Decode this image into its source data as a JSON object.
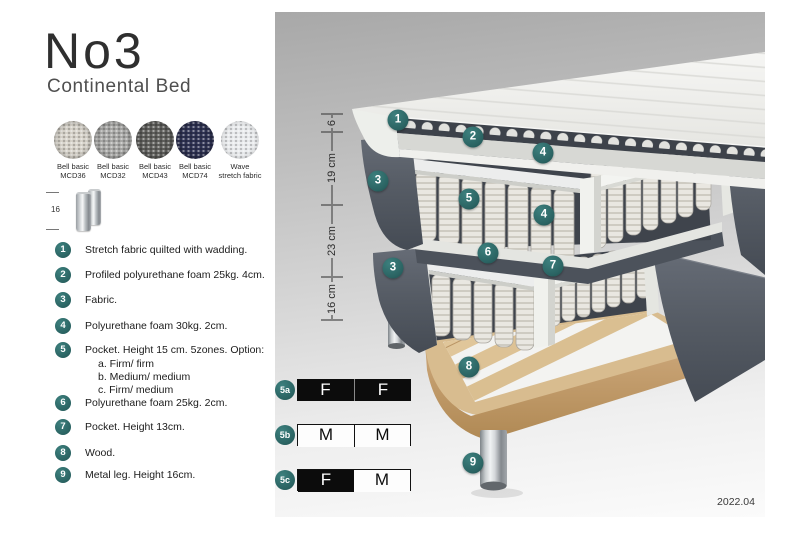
{
  "header": {
    "title": "No3",
    "subtitle": "Continental Bed"
  },
  "swatches": {
    "items": [
      {
        "line1": "Bell basic",
        "line2": "MCD36",
        "color": "#d6d2c9"
      },
      {
        "line1": "Bell basic",
        "line2": "MCD32",
        "color": "#a8a8a6"
      },
      {
        "line1": "Bell basic",
        "line2": "MCD43",
        "color": "#5e5e5b"
      },
      {
        "line1": "Bell basic",
        "line2": "MCD74",
        "color": "#2e3252"
      },
      {
        "line1": "Wave",
        "line2": "stretch fabric",
        "color": "#e9ebed"
      }
    ]
  },
  "leg_detail": {
    "dimension": "16"
  },
  "legend": {
    "badge_color": "#2e6e6d",
    "items": [
      {
        "num": "1",
        "text": "Stretch fabric quilted with wadding."
      },
      {
        "num": "2",
        "text": "Profiled polyurethane foam 25kg. 4cm."
      },
      {
        "num": "3",
        "text": "Fabric."
      },
      {
        "num": "4",
        "text": "Polyurethane foam 30kg. 2cm."
      },
      {
        "num": "5",
        "text": "Pocket. Height 15 cm. 5zones. Option:",
        "options": [
          "a. Firm/ firm",
          "b. Medium/ medium",
          "c. Firm/ medium"
        ]
      },
      {
        "num": "6",
        "text": "Polyurethane foam 25kg. 2cm."
      },
      {
        "num": "7",
        "text": "Pocket. Height 13cm."
      },
      {
        "num": "8",
        "text": "Wood."
      },
      {
        "num": "9",
        "text": "Metal leg. Height 16cm."
      }
    ]
  },
  "diagram": {
    "dimension_labels": [
      "6",
      "19 cm",
      "23 cm",
      "16 cm"
    ],
    "callouts": [
      {
        "num": "1"
      },
      {
        "num": "2"
      },
      {
        "num": "4"
      },
      {
        "num": "3"
      },
      {
        "num": "5"
      },
      {
        "num": "4"
      },
      {
        "num": "6"
      },
      {
        "num": "7"
      },
      {
        "num": "3"
      },
      {
        "num": "8"
      },
      {
        "num": "9"
      }
    ],
    "firmness_options": [
      {
        "id": "5a",
        "left": {
          "label": "F",
          "variant": "dark"
        },
        "right": {
          "label": "F",
          "variant": "dark"
        }
      },
      {
        "id": "5b",
        "left": {
          "label": "M",
          "variant": "light"
        },
        "right": {
          "label": "M",
          "variant": "light"
        }
      },
      {
        "id": "5c",
        "left": {
          "label": "F",
          "variant": "dark"
        },
        "right": {
          "label": "M",
          "variant": "light"
        }
      }
    ],
    "version": "2022.04",
    "colors": {
      "callout": "#2e6e6d",
      "fabric_dark": "#575d66",
      "wood": "#d8bc8f",
      "frame": "#eceded"
    }
  }
}
